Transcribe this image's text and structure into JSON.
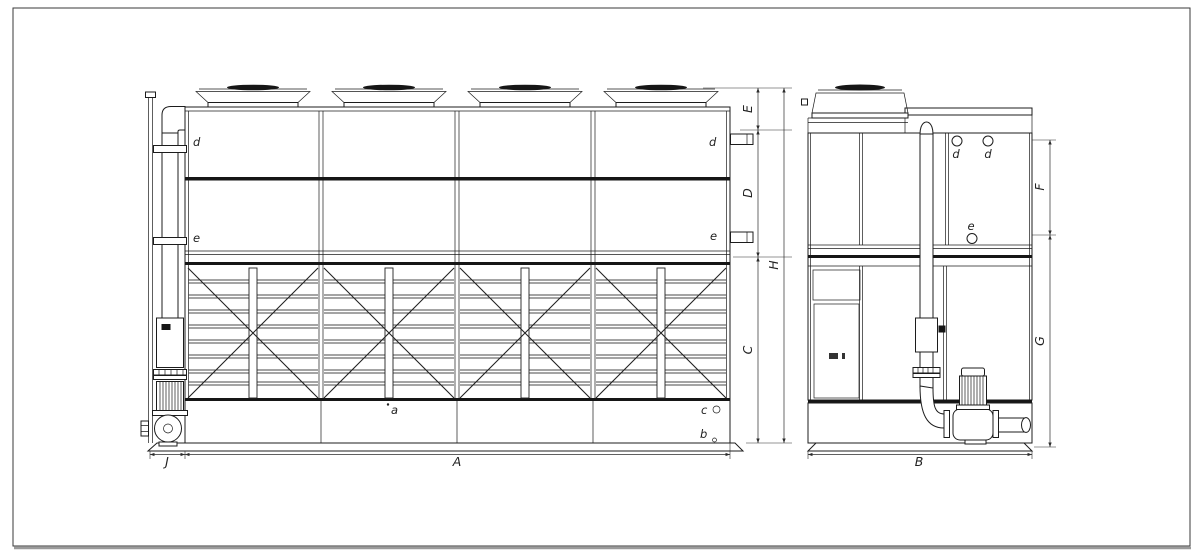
{
  "drawing": {
    "colors": {
      "background": "#ffffff",
      "line": "#1c1c1c",
      "dimension_line": "#2b2b2b",
      "dark_fill": "#161616",
      "frame": "#3a3a3a",
      "frame_shadow": "#9a9a9a"
    },
    "front_view": {
      "part_labels": {
        "d_left": "d",
        "d_right": "d",
        "e_left": "e",
        "e_right": "e",
        "a": "a",
        "b": "b",
        "c": "c"
      }
    },
    "side_view": {
      "part_labels": {
        "d_first": "d",
        "d_second": "d",
        "e": "e"
      }
    },
    "dimensions": {
      "A": "A",
      "B": "B",
      "C": "C",
      "D": "D",
      "E": "E",
      "F": "F",
      "G": "G",
      "H": "H",
      "J": "J"
    }
  }
}
